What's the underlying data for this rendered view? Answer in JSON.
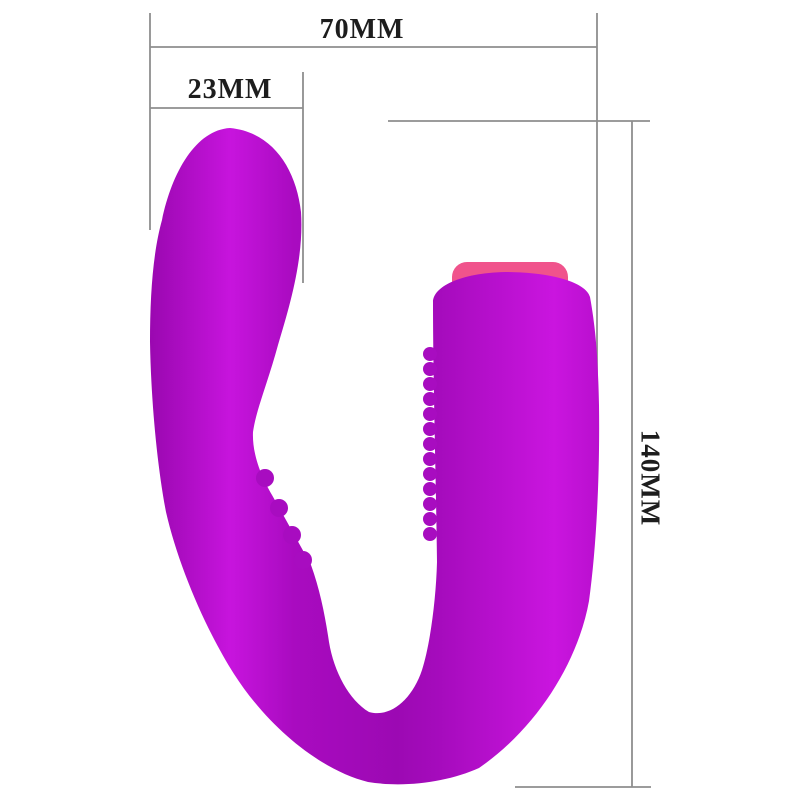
{
  "diagram": {
    "title": "product-dimension-diagram",
    "background": "#ffffff",
    "labels": {
      "width_total": "70MM",
      "width_tip": "23MM",
      "height_total": "140MM"
    },
    "colors": {
      "body_dark": "#9a08b0",
      "body_highlight_left": "#c714dd",
      "body_mid": "#a90bc0",
      "body_shadow": "#9c09b3",
      "body_arm_edge": "#a50bbc",
      "body_highlight_right": "#ca15df",
      "body_base": "#b90fce",
      "accent_pink": "#f0538c",
      "rib": "#a80cc0",
      "dimension_line": "#8e8e8e",
      "label_text": "#1d1d1d"
    }
  }
}
